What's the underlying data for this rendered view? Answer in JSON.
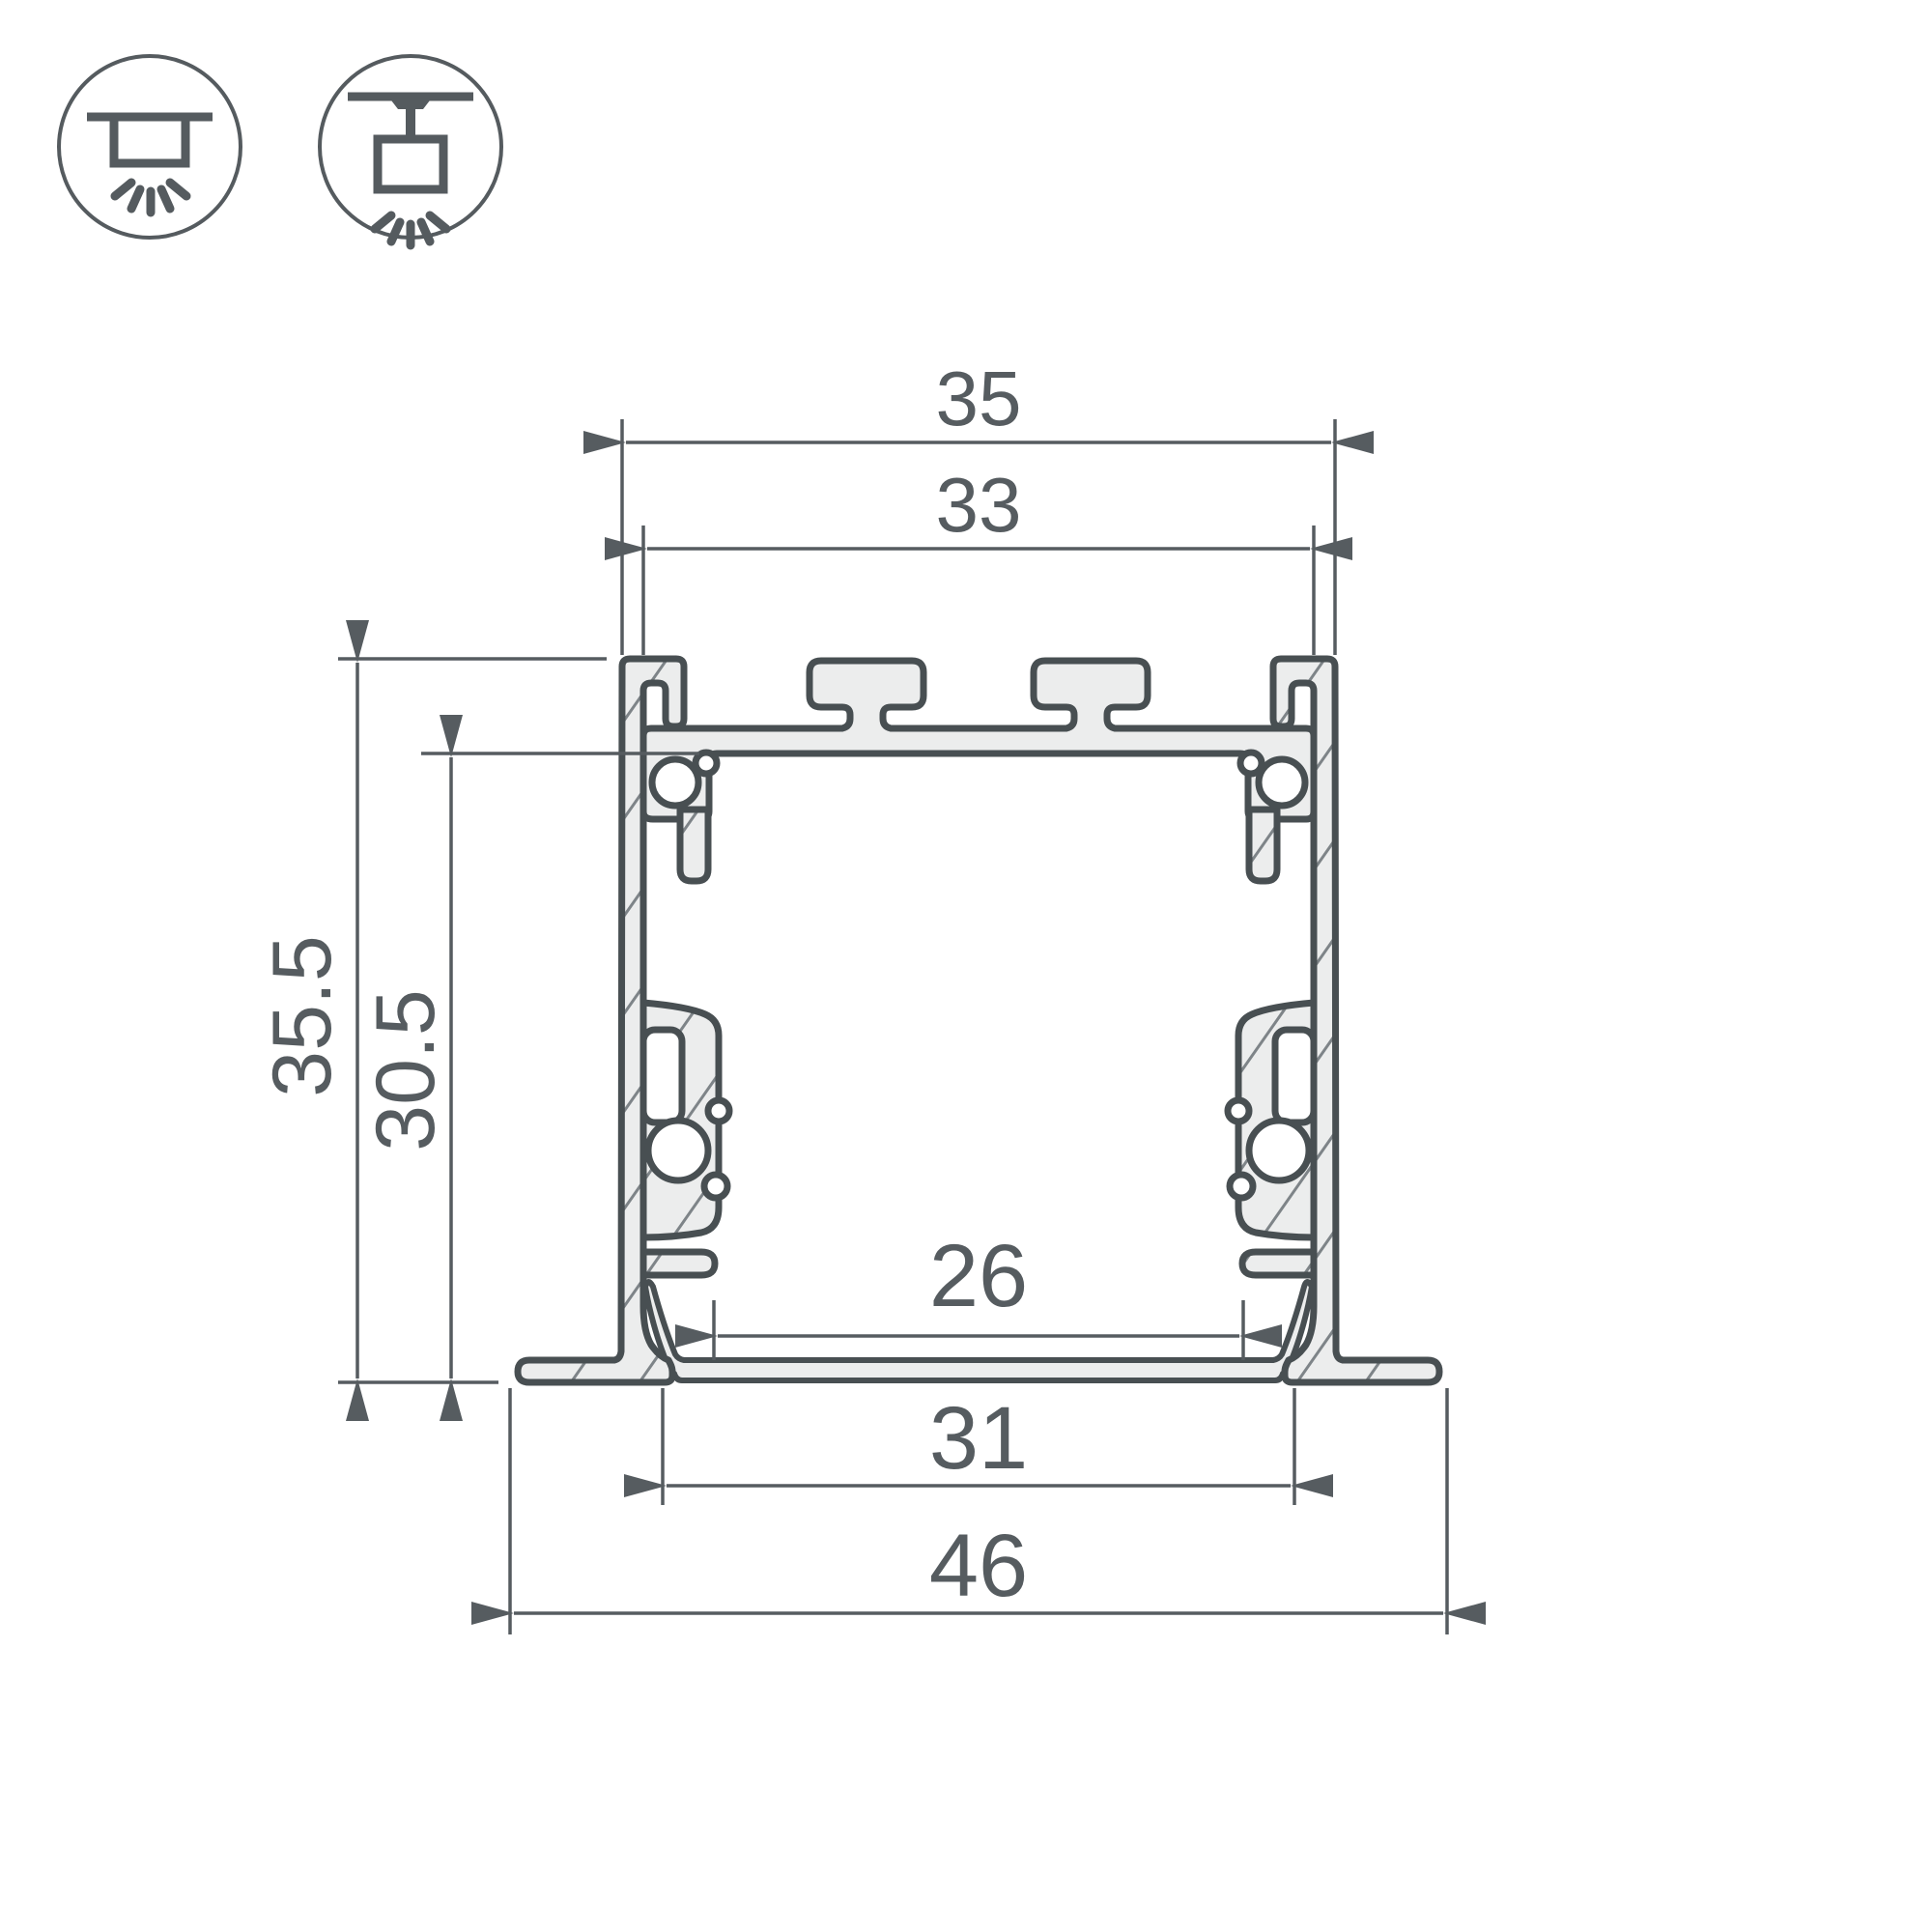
{
  "title": "LED profile cross-section technical drawing",
  "mounting_icons": [
    {
      "name": "recessed-mount-icon",
      "description": "luminaire recessed into ceiling, light rays below"
    },
    {
      "name": "surface-mount-icon",
      "description": "luminaire mounted below ceiling on stem, light rays below"
    }
  ],
  "dimensions": {
    "outer_width": "35",
    "top_inner_width": "33",
    "outer_height": "35.5",
    "inner_height": "30.5",
    "bottom_inner_width": "26",
    "cutout_width": "31",
    "flange_width": "46"
  },
  "colors": {
    "background": "#ffffff",
    "profile_outline": "#484f52",
    "material_fill": "#eceded",
    "hatch_line": "#7e8488",
    "dimension_line": "#565c60",
    "icon_line": "#555b5f"
  }
}
